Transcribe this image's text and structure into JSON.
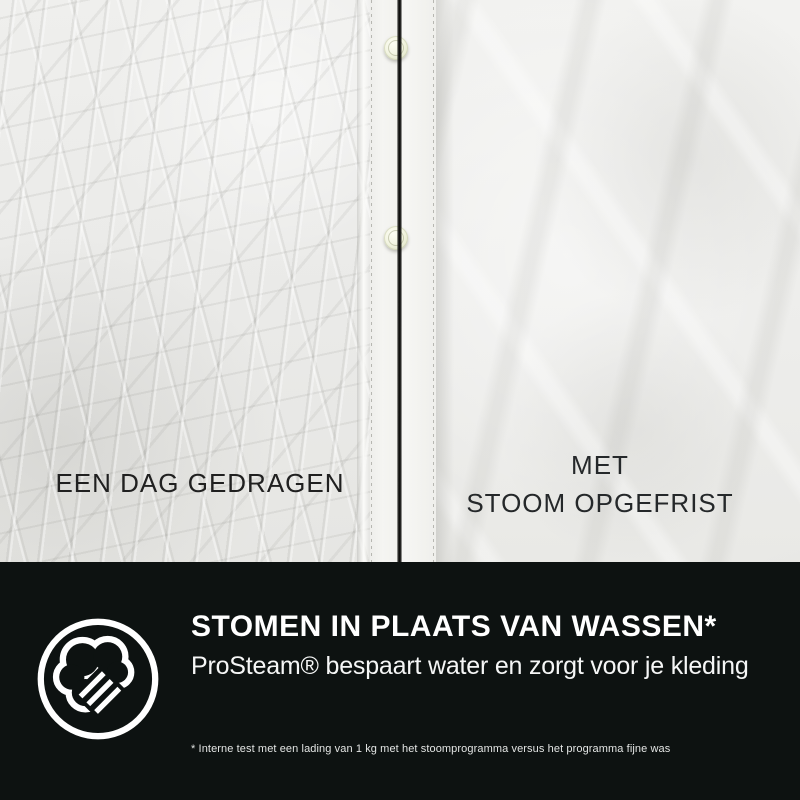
{
  "colors": {
    "banner_background": "#0d1211",
    "banner_text": "#ffffff",
    "photo_caption_left": "#202020",
    "photo_caption_right": "#25282a",
    "split_line": "#0c0c0b"
  },
  "photo": {
    "left_caption": "EEN DAG GEDRAGEN",
    "right_caption_line1": "MET",
    "right_caption_line2": "STOOM OPGEFRIST"
  },
  "banner": {
    "icon": "steam-cloud-icon",
    "heading": "STOMEN IN PLAATS VAN WASSEN*",
    "subheading": "ProSteam® bespaart water en zorgt voor je kleding",
    "footnote": "* Interne test met een lading van 1 kg met het stoomprogramma versus het programma fijne was"
  }
}
